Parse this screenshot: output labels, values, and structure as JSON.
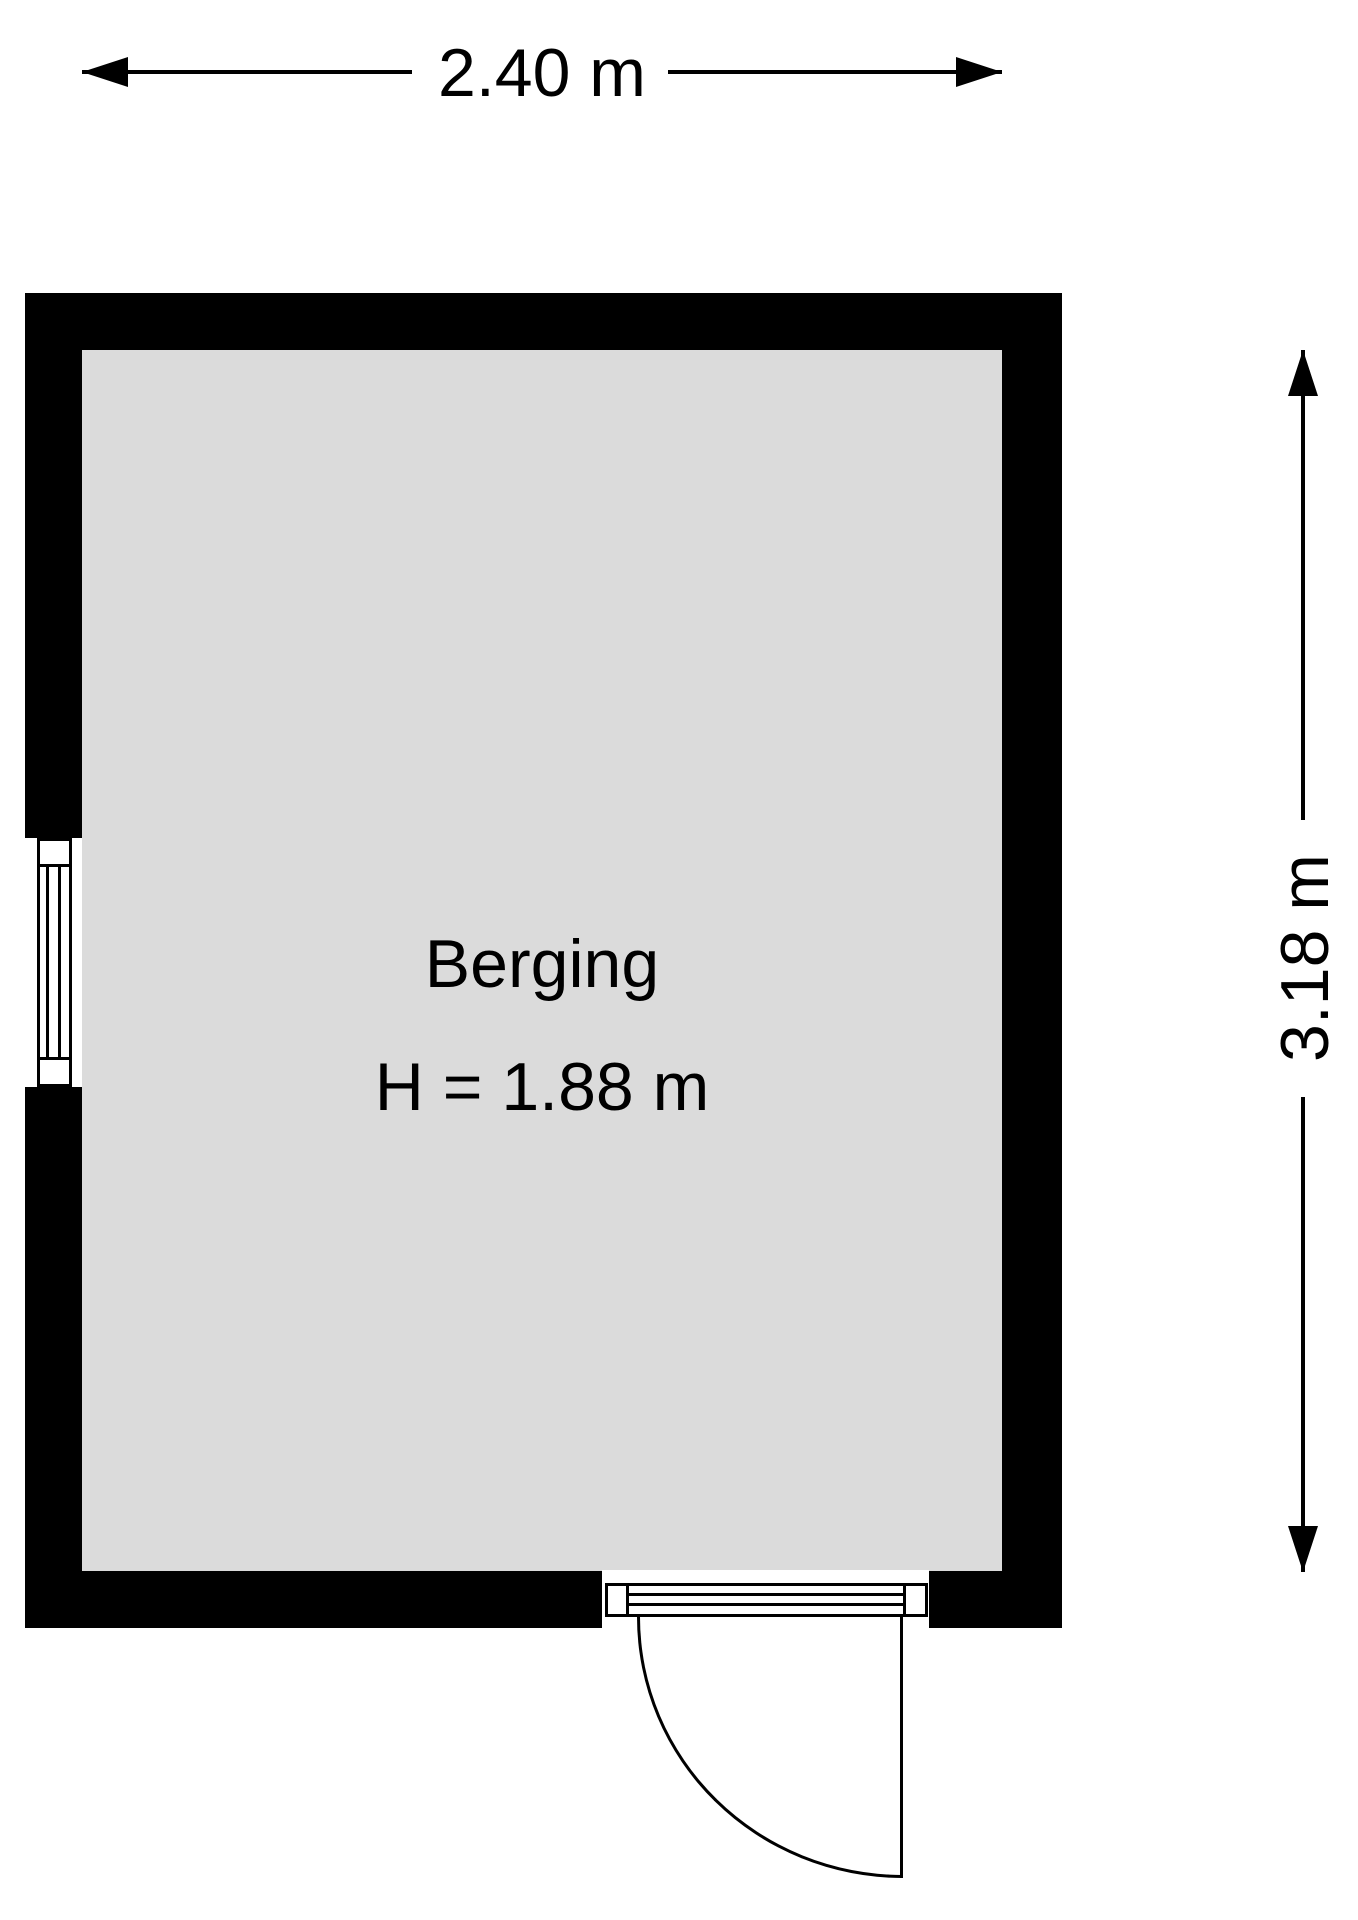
{
  "floorplan": {
    "room": {
      "name": "Berging",
      "height_label": "H = 1.88 m"
    },
    "dimensions": {
      "width_label": "2.40 m",
      "height_label": "3.18 m"
    },
    "colors": {
      "wall": "#000000",
      "floor": "#dbdbdb",
      "line": "#000000",
      "background": "#ffffff"
    }
  }
}
